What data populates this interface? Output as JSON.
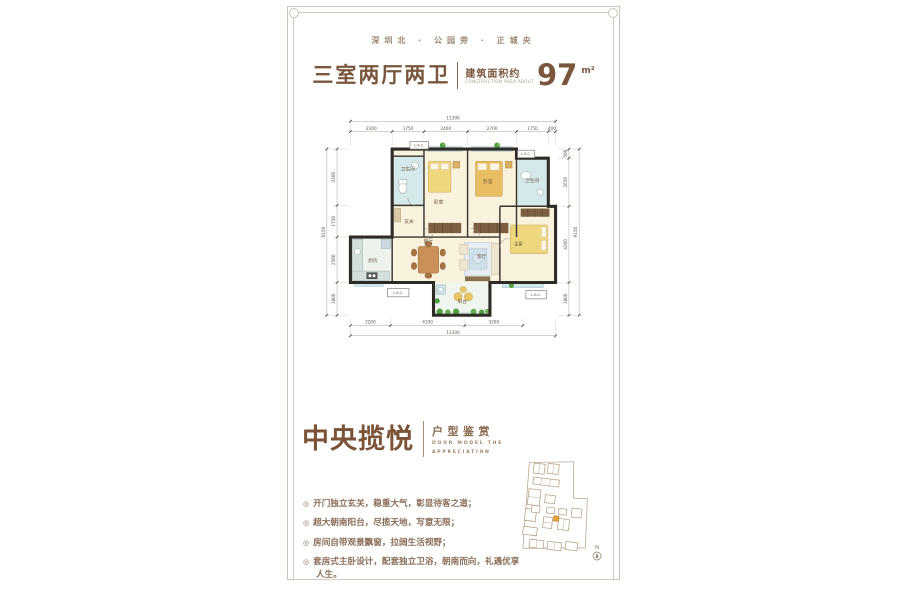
{
  "header": {
    "tagline": "深圳北 · 公园旁 · 正城央",
    "title_rooms": "三室两厅两卫",
    "area_label": "建筑面积约",
    "area_label_en": "CONSTRUCTION AREA ABOUT",
    "area_value": "97",
    "area_unit": "m²"
  },
  "plan": {
    "rooms": {
      "bath1": "卫生间",
      "bedroom1": "卧室",
      "bedroom2": "卧室",
      "bath2": "卫生间",
      "foyer": "玄关",
      "kitchen": "厨房",
      "dining": "餐厅",
      "living": "客厅",
      "master": "主卧",
      "balcony": "阳台"
    },
    "lac": "L.A.C.",
    "dims": {
      "top_total": "11300",
      "top_segments": [
        "2300",
        "1750",
        "2400",
        "2700",
        "1750",
        "400"
      ],
      "bottom_segments": [
        "2200",
        "4100",
        "3200"
      ],
      "bottom_total": "11300",
      "left_total": "9150",
      "left_segments": [
        "3100",
        "1750",
        "2500",
        "1800"
      ],
      "right_total": "9150",
      "right_segments": [
        "500",
        "2650",
        "4200",
        "1800"
      ]
    }
  },
  "section": {
    "name": "中央揽悦",
    "subtitle": "户型鉴赏",
    "subtitle_en1": "DOOR MODEL THE",
    "subtitle_en2": "APPRECIATION",
    "bullet_marker": "◎",
    "bullets": [
      "开门独立玄关，稳重大气，彰显待客之道；",
      "超大朝南阳台，尽揽天地，写意无限；",
      "房间自带观景飘窗，拉阔生活视野；",
      "套房式主卧设计，配套独立卫浴，朝南而向，礼遇优享人生。"
    ],
    "north_label": "N"
  },
  "colors": {
    "brown_title": "#7a573c",
    "brown_text": "#8a6d58",
    "frame_border": "#cdc2b6",
    "wall": "#2e2a25",
    "room_cream": "#f9f2dc",
    "room_bath": "#d6e9ea",
    "balcony": "#f0f6ef",
    "plant_green": "#4f9e3f",
    "bed_yellow": "#eed77e",
    "key_highlight": "#e8a33d"
  }
}
